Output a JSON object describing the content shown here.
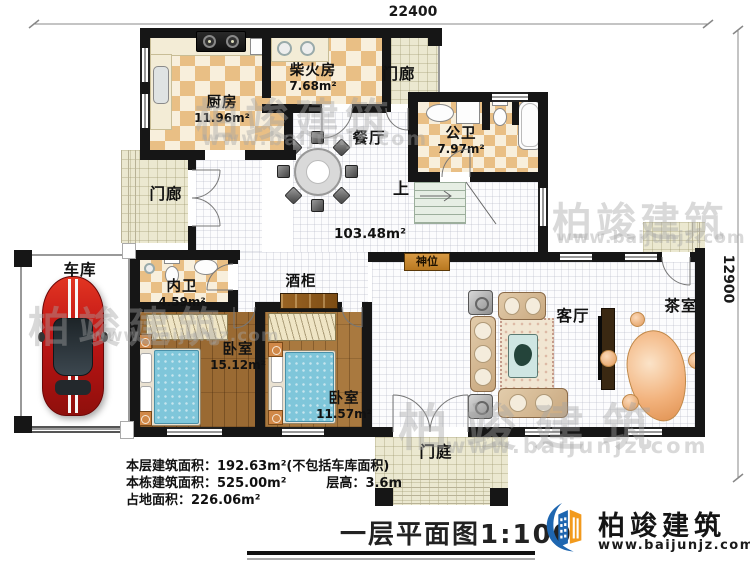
{
  "plan": {
    "dim_top": "22400",
    "dim_right": "12900",
    "hall_area": "103.48m²",
    "stairs_up": "上",
    "shrine": "神位",
    "wine_cabinet": "酒柜",
    "rooms": {
      "kitchen": {
        "name": "厨房",
        "area": "11.96m²"
      },
      "firewood": {
        "name": "柴火房",
        "area": "7.68m²"
      },
      "porch_top": {
        "name": "门廊"
      },
      "porch_west": {
        "name": "门廊"
      },
      "dining": {
        "name": "餐厅"
      },
      "public_bath": {
        "name": "公卫",
        "area": "7.97m²"
      },
      "private_bath": {
        "name": "内卫",
        "area": "4.59m²"
      },
      "garage": {
        "name": "车库"
      },
      "bedroom_1": {
        "name": "卧室",
        "area": "15.12m²"
      },
      "bedroom_2": {
        "name": "卧室",
        "area": "11.57m²"
      },
      "living": {
        "name": "客厅"
      },
      "tea": {
        "name": "茶室"
      },
      "entry": {
        "name": "门庭"
      }
    }
  },
  "info": {
    "floor_area_label": "本层建筑面积：",
    "floor_area": "192.63m²(不包括车库面积)",
    "building_area_label": "本栋建筑面积：",
    "building_area": "525.00m²",
    "storey_height_label": "层高：",
    "storey_height": "3.6m",
    "land_area_label": "占地面积：",
    "land_area": "226.06m²"
  },
  "title": "一层平面图1:100",
  "brand": {
    "name": "柏竣建筑",
    "url": "www.baijunjz.com"
  },
  "watermark": {
    "text": "柏竣建筑",
    "url": "www.baijunjz.com"
  },
  "colors": {
    "wall": "#161616",
    "checker_dark": "#e9bf85",
    "checker_light": "#f8efdc",
    "wood": "#a9793f",
    "brand_blue": "#1e66b0",
    "brand_orange": "#f29a1d"
  }
}
